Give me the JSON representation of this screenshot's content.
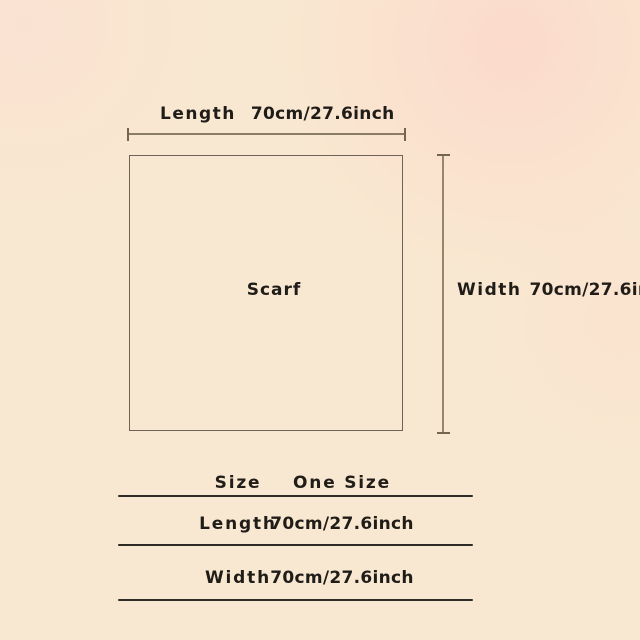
{
  "diagram": {
    "shape_label": "Scarf",
    "top_label": {
      "name": "Length",
      "value": "70cm/27.6inch"
    },
    "right_label": {
      "name": "Width",
      "value": "70cm/27.6inch"
    }
  },
  "table": {
    "header": {
      "col1": "Size",
      "col2": "One Size"
    },
    "rows": [
      {
        "label": "Length",
        "value": "70cm/27.6inch"
      },
      {
        "label": "Width",
        "value": "70cm/27.6inch"
      }
    ]
  },
  "colors": {
    "background": "#f9e8d1",
    "background_blush": "#fcd6ca",
    "text": "#201d19",
    "square_outline": "#6e6354",
    "measure_line": "#8b7c67",
    "table_rule": "#2e2b27"
  }
}
